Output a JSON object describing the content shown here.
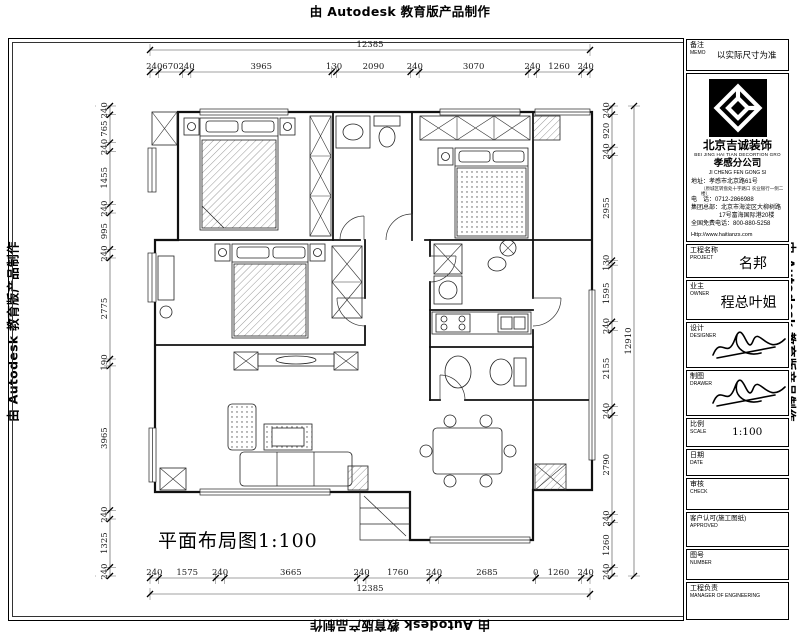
{
  "watermark": {
    "text": "由 Autodesk 教育版产品制作"
  },
  "plan": {
    "caption": "平面布局图1:100"
  },
  "dims": {
    "top": {
      "overall": [
        12385
      ],
      "values": [
        240,
        670,
        240,
        3965,
        130,
        2090,
        240,
        3070,
        240,
        1260,
        240
      ]
    },
    "bottom": {
      "overall": [
        12385
      ],
      "values": [
        240,
        1575,
        240,
        3665,
        240,
        1760,
        240,
        2685,
        0,
        1260,
        240
      ]
    },
    "left": {
      "overall": [
        12910
      ],
      "values": [
        240,
        765,
        240,
        1455,
        240,
        995,
        240,
        2775,
        190,
        3965,
        240,
        1325,
        240
      ]
    },
    "right": {
      "overall": [
        12910
      ],
      "values": [
        240,
        920,
        240,
        2955,
        130,
        1595,
        240,
        2155,
        240,
        2790,
        240,
        1260,
        240
      ]
    }
  },
  "title_block": {
    "memo": {
      "label_cn": "备注",
      "label_en": "MEMO",
      "value": "以实际尺寸为准"
    },
    "company": {
      "name_cn": "北京吉诚装饰",
      "name_en": "BEI JING HAI TIAN DECORTION GRO",
      "branch_cn": "孝感分公司",
      "branch_en": "JI CHENG FEN GONG SI",
      "address_label": "地址：",
      "address": "孝感市北京路61号",
      "address_note": "（原城区转盘处十字路口 农业银行一侧二楼）",
      "phone_label": "电　话：",
      "phone": "0712-2866988",
      "hq_label": "集团总部：",
      "hq_line1": "北京市海淀区大柳树路",
      "hq_line2": "17号富海国际港20楼",
      "hotline_label": "全国免费电话：",
      "hotline": "800-880-5258",
      "website": "Http://www.haitianzs.com"
    },
    "rows": [
      {
        "label_cn": "工程名称",
        "label_en": "PROJECT",
        "value": "名邦"
      },
      {
        "label_cn": "业主",
        "label_en": "OWNER",
        "value": "程总叶姐"
      },
      {
        "label_cn": "设计",
        "label_en": "DESIGNER",
        "value": ""
      },
      {
        "label_cn": "制图",
        "label_en": "DRAWER",
        "value": ""
      },
      {
        "label_cn": "比例",
        "label_en": "SCALE",
        "value": "1:100"
      },
      {
        "label_cn": "日期",
        "label_en": "DATE",
        "value": ""
      },
      {
        "label_cn": "审核",
        "label_en": "CHECK",
        "value": ""
      },
      {
        "label_cn": "客户认可(施工图纸)",
        "label_en": "APPROVED",
        "value": ""
      },
      {
        "label_cn": "图号",
        "label_en": "NUMBER",
        "value": ""
      },
      {
        "label_cn": "工程负责",
        "label_en": "MANAGER OF ENGINEERING",
        "value": ""
      }
    ]
  }
}
